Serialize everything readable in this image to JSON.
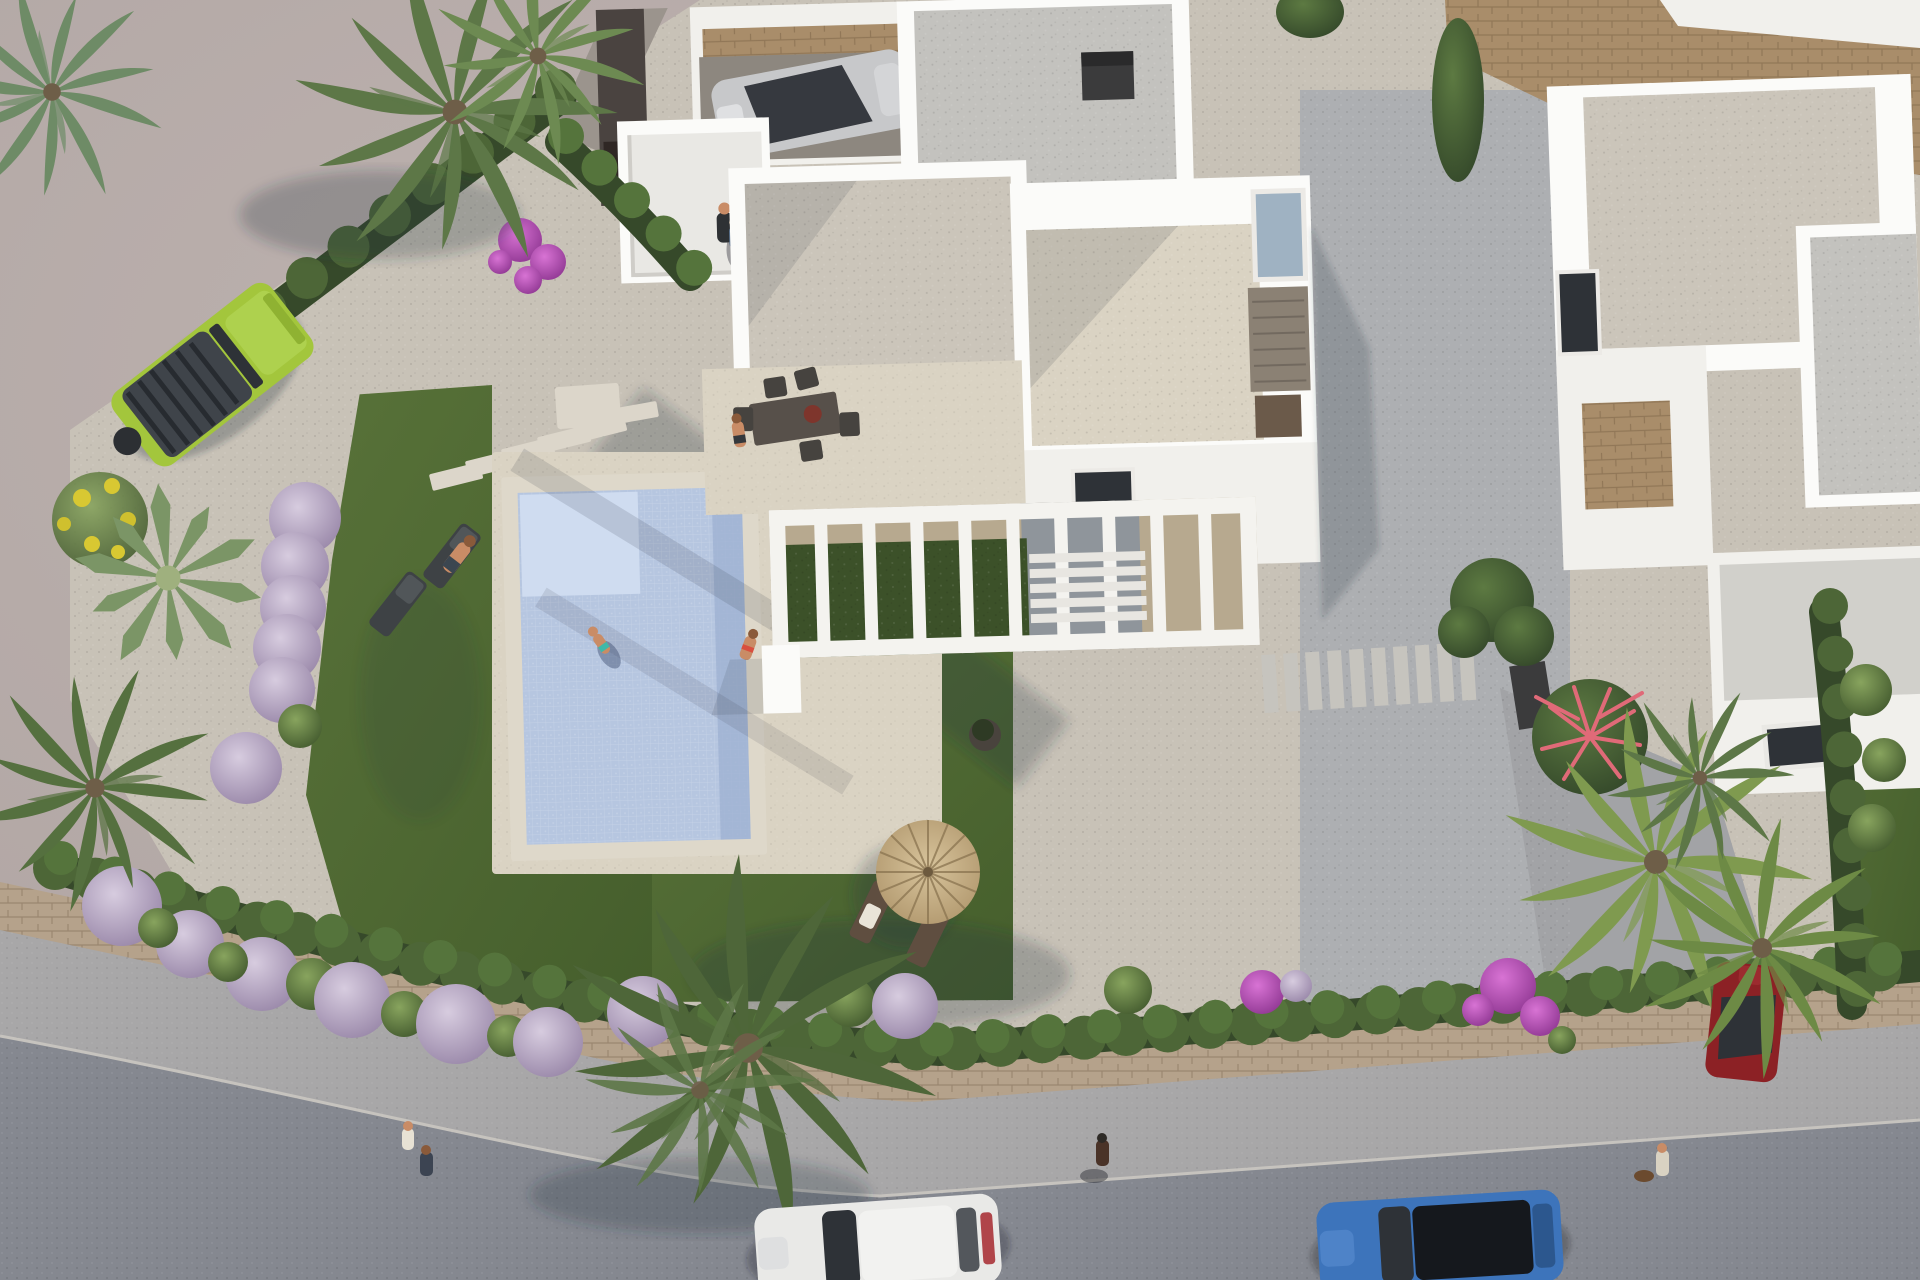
{
  "meta": {
    "title": "Aerial 3D render of a modern white villa with pool and garden",
    "description": "Top-down architectural visualization: flat-roofed white villa with gravel roofs, rectangular tiled pool with swimmers, lawns with sun loungers, straw parasol, pergola with climbing plants, lilac and green topiary bushes, palm trees, lime-green SUV parked beside the garden, neighbouring villa with driveway and dark-red car, street at the bottom with a white car and a blue car, pedestrians and a dog on the sidewalk."
  },
  "colors": {
    "pavement": "#b5aaa7",
    "road": "#858890",
    "sidewalk": "#a8a7a8",
    "wall-stone": "#b5a28b",
    "gravel-warm": "#c8c2b7",
    "gravel-cool": "#adafb2",
    "concrete": "#a2a3a6",
    "white-wall": "#f1f0ec",
    "white-bright": "#fbfbf9",
    "roof-gravel": "#cbc5ba",
    "roof-cool": "#c3c2be",
    "deck": "#dad3c3",
    "lawn": "#506934",
    "pool-coping": "#ded8ca",
    "pool-water": "#b6c6e0",
    "pool-light": "#cfdcf0",
    "pool-deep": "#9fb2d2",
    "hedge-dark": "#36492a",
    "hedge-mid": "#4d6637",
    "palm-green": "#5d7747",
    "palm-dark": "#41572f",
    "palm-yellow": "#7f9a4f",
    "agave": "#7b9566",
    "straw": "#c7ae84",
    "jeep-green": "#a3c63c",
    "car-white": "#e9e9e7",
    "car-blue": "#3d74bb",
    "car-red": "#8c2125",
    "car-silver": "#c7c8ca",
    "glass-dark": "#2e3237",
    "skin": "#c98c66",
    "shadow": "rgba(40,45,60,0.25)",
    "dark-fixture": "#3b3b3c",
    "wood": "#6b5a4a",
    "bush-lilac-light": "#d7ccdf",
    "bush-lilac-dark": "#9684a6",
    "bush-green-light": "#88a45e",
    "bush-green-dark": "#41582d",
    "bush-magenta-light": "#d873d4",
    "bush-magenta-dark": "#8d3590",
    "tan-wall": "#a98d6a"
  },
  "scene": {
    "setting": "aerial top-down view, daylight, long soft shadows toward lower-left",
    "objects": [
      {
        "name": "main-villa",
        "kind": "building",
        "pos": [
          980,
          280
        ],
        "note": "white parapet walls, gravel flat roofs, carport with silver car, roof terrace with family"
      },
      {
        "name": "neighbor-villa",
        "kind": "building",
        "pos": [
          1740,
          320
        ],
        "note": "white villa with gravel roof, stone-clad wall, garage with skylight"
      },
      {
        "name": "swimming-pool",
        "kind": "pool",
        "pos": [
          633,
          665
        ],
        "note": "rectangular, light-blue mosaic tiles, shallow step zone top-left, one swimmer, one woman seated on edge"
      },
      {
        "name": "pergola",
        "kind": "structure",
        "pos": [
          1005,
          578
        ],
        "note": "white beam pergola with climbing greenery"
      },
      {
        "name": "dining-set",
        "kind": "furniture",
        "pos": [
          792,
          414
        ],
        "note": "dark outdoor table, chairs, red bowl, one seated person"
      },
      {
        "name": "sun-loungers-left",
        "kind": "furniture",
        "pos": [
          430,
          575
        ],
        "count": 2,
        "note": "dark gray loungers on lawn, one person"
      },
      {
        "name": "straw-parasol",
        "kind": "furniture",
        "pos": [
          925,
          872
        ],
        "note": "round thatched umbrella with two brown loungers"
      },
      {
        "name": "green-suv",
        "kind": "vehicle",
        "pos": [
          203,
          382
        ],
        "note": "lime green SUV with dark ribbed roof, parked on street corner"
      },
      {
        "name": "silver-car",
        "kind": "vehicle",
        "pos": [
          830,
          97
        ],
        "note": "parked in carport"
      },
      {
        "name": "white-car",
        "kind": "vehicle",
        "pos": [
          878,
          1245
        ],
        "note": "driving on bottom street"
      },
      {
        "name": "blue-car",
        "kind": "vehicle",
        "pos": [
          1440,
          1243
        ],
        "note": "driving on bottom street, black panoramic roof"
      },
      {
        "name": "red-car",
        "kind": "vehicle",
        "pos": [
          1746,
          1024
        ],
        "note": "parked on neighbor driveway under palms"
      },
      {
        "name": "palm-top-left",
        "kind": "plant",
        "pos": [
          455,
          110
        ]
      },
      {
        "name": "palm-bottom-center",
        "kind": "plant",
        "pos": [
          748,
          1050
        ]
      },
      {
        "name": "palm-cluster-right",
        "kind": "plant",
        "pos": [
          1700,
          890
        ]
      },
      {
        "name": "agave",
        "kind": "plant",
        "pos": [
          168,
          578
        ]
      },
      {
        "name": "lilac-topiary-row-left",
        "kind": "plant",
        "pos": [
          285,
          630
        ],
        "count": 6
      },
      {
        "name": "boundary-hedge",
        "kind": "plant",
        "pos": [
          900,
          1010
        ],
        "note": "scalloped green hedge on stone wall along street"
      },
      {
        "name": "bougainvillea",
        "kind": "plant",
        "pos": [
          532,
          255
        ]
      },
      {
        "name": "coral-plant",
        "kind": "plant",
        "pos": [
          1590,
          737
        ]
      },
      {
        "name": "pedestrians-left",
        "kind": "people",
        "pos": [
          415,
          1148
        ],
        "count": 2
      },
      {
        "name": "pedestrian-center",
        "kind": "people",
        "pos": [
          1102,
          1158
        ],
        "count": 1
      },
      {
        "name": "pedestrian-with-dog",
        "kind": "people",
        "pos": [
          1662,
          1165
        ],
        "count": 1
      },
      {
        "name": "family-on-terrace",
        "kind": "people",
        "pos": [
          727,
          222
        ],
        "count": 2
      },
      {
        "name": "street",
        "kind": "road",
        "pos": [
          960,
          1230
        ]
      },
      {
        "name": "stone-retaining-wall",
        "kind": "wall",
        "pos": [
          1690,
          80
        ]
      }
    ]
  }
}
